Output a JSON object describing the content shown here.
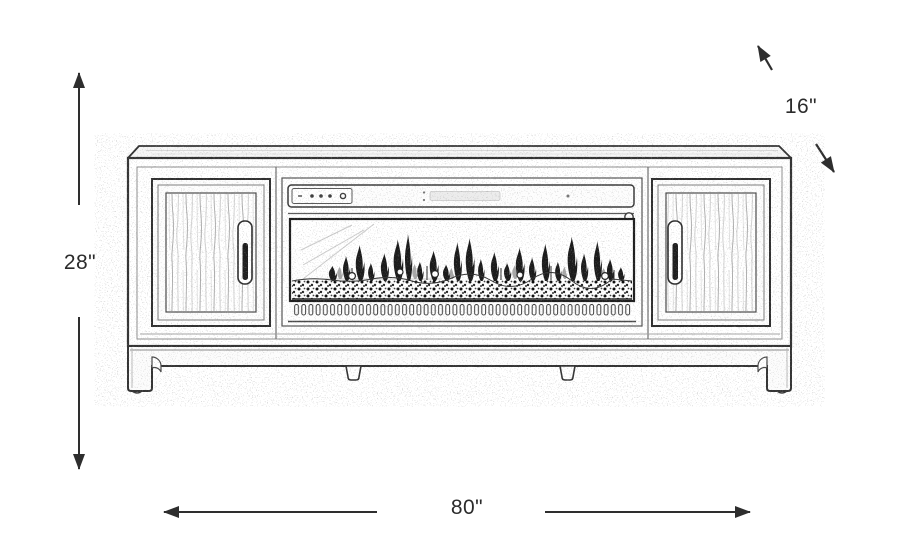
{
  "diagram": {
    "subject": "tv-console-with-electric-fireplace-line-drawing",
    "dimensions": {
      "height": {
        "label": "28\""
      },
      "width": {
        "label": "80\""
      },
      "depth": {
        "label": "16\""
      }
    },
    "colors": {
      "background": "#ffffff",
      "line": "#343434",
      "dimension_text": "#2b2b2b"
    }
  }
}
